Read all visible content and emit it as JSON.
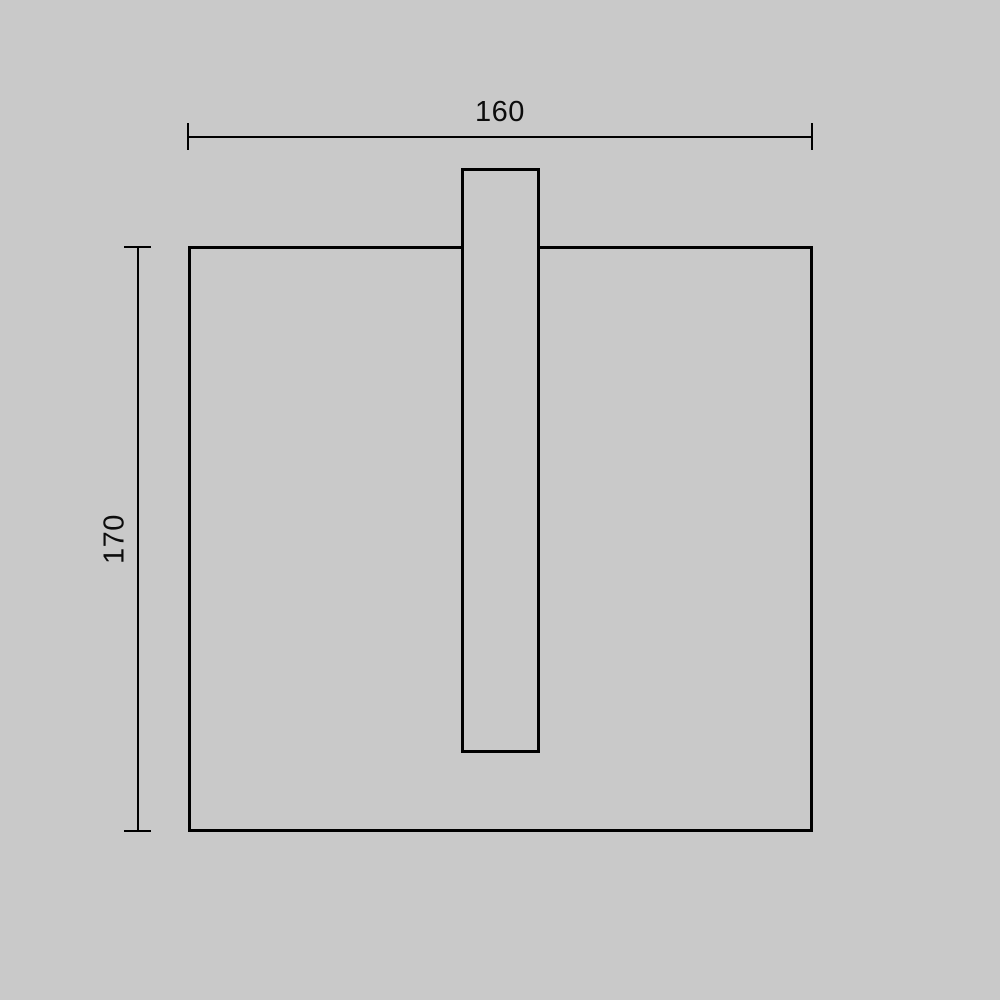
{
  "page": {
    "background_color": "#c9c9c9",
    "line_color": "#000000",
    "description": "Technical dimension drawing of a square wall-lamp body with a narrow vertical slot tab protruding through its top edge"
  },
  "drawing": {
    "shapes": [
      {
        "name": "main-body",
        "type": "rectangle-outline"
      },
      {
        "name": "slot-tab",
        "type": "rectangle-outline"
      }
    ],
    "dimensions": [
      {
        "label": "160",
        "orientation": "horizontal",
        "position": "top"
      },
      {
        "label": "170",
        "orientation": "vertical",
        "position": "left"
      }
    ]
  }
}
